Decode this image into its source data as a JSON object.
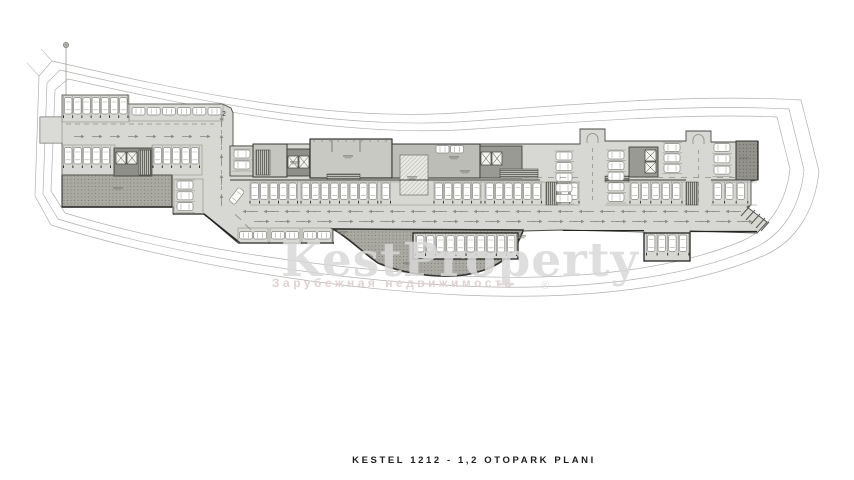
{
  "title": "KESTEL 1212 - 1,2 OTOPARK  PLANI",
  "watermark": {
    "brand": "KestProperty",
    "subtitle": "Зарубежная недвижимость",
    "registered": "®"
  },
  "plan": {
    "level_label": "2",
    "colors": {
      "structure_fill": "#d7d7d3",
      "building_fill": "#c6c6c0",
      "core_fill": "#8f8f89",
      "stipple_fill": "#a9a9a1",
      "outline": "#3a3a38",
      "boundary_line": "#b0b0ac",
      "road_mark": "#8a8a84",
      "car_fill": "#ffffff",
      "watermark_gray": "#d9d9d9",
      "watermark_rose": "#e0d2d2",
      "title_color": "#1c1c1c"
    },
    "rows_vertical_cars": [
      {
        "x": 64.5,
        "y": 97.5,
        "n": 7,
        "p": 9.2
      },
      {
        "x": 64.5,
        "y": 147.5,
        "n": 5,
        "p": 9.4
      },
      {
        "x": 154,
        "y": 147.5,
        "n": 5,
        "p": 9.3
      },
      {
        "x": 251,
        "y": 183,
        "n": 5,
        "p": 9.5
      },
      {
        "x": 302,
        "y": 183,
        "n": 8,
        "p": 9.6
      },
      {
        "x": 382,
        "y": 183,
        "n": 1,
        "p": 9.5
      },
      {
        "x": 435,
        "y": 183,
        "n": 5,
        "p": 9.4
      },
      {
        "x": 486,
        "y": 183,
        "n": 6,
        "p": 9.4
      },
      {
        "x": 561,
        "y": 183,
        "n": 2,
        "p": 9.5
      },
      {
        "x": 631,
        "y": 183,
        "n": 5,
        "p": 10.4
      },
      {
        "x": 714,
        "y": 183,
        "n": 3,
        "p": 11.6
      },
      {
        "x": 416.5,
        "y": 235.5,
        "n": 10,
        "p": 10.1
      },
      {
        "x": 647.5,
        "y": 235,
        "n": 4,
        "p": 10.6
      }
    ],
    "rows_horizontal_cars": [
      {
        "x": 132,
        "y": 107.5,
        "n": 6,
        "p": 15.2
      },
      {
        "x": 239.5,
        "y": 231.5,
        "n": 2,
        "p": 14
      },
      {
        "x": 271.5,
        "y": 231.5,
        "n": 2,
        "p": 14
      },
      {
        "x": 303.5,
        "y": 231.5,
        "n": 2,
        "p": 14
      },
      {
        "x": 436,
        "y": 145.5,
        "n": 2,
        "p": 14.5
      }
    ],
    "cols_horizontal_cars": [
      {
        "x": 177,
        "y": 181,
        "n": 3,
        "p": 10.8
      },
      {
        "x": 234,
        "y": 150,
        "n": 2,
        "p": 11
      },
      {
        "x": 556,
        "y": 152,
        "n": 5,
        "p": 10.6
      },
      {
        "x": 608,
        "y": 151,
        "n": 5,
        "p": 10.6
      },
      {
        "x": 664,
        "y": 143.5,
        "n": 3,
        "p": 10.4
      },
      {
        "x": 714,
        "y": 143.5,
        "n": 3,
        "p": 11.3
      }
    ],
    "angled_car": {
      "x": 233,
      "y": 188,
      "deg": 38
    },
    "aisle_dash": {
      "x1": 66,
      "x2": 214,
      "y": 124
    },
    "aisle_arrows": {
      "y": 136.5,
      "x1": 76,
      "step": 18,
      "n": 8
    },
    "vroad": {
      "x": 221.5,
      "y1": 114,
      "y2": 203,
      "arrows": [
        198,
        178,
        158,
        138,
        120
      ]
    },
    "road_lines": [
      {
        "y": 211.5,
        "x1": 250,
        "x2": 738,
        "step": 21,
        "dir": "left"
      },
      {
        "y": 221.5,
        "x1": 254,
        "x2": 742,
        "step": 21,
        "dir": "right"
      }
    ],
    "mid_aisle_dashes": [
      {
        "y": 177.5,
        "x1": 524,
        "x2": 578,
        "step": 12
      },
      {
        "y": 177.5,
        "x1": 633,
        "x2": 757,
        "step": 12
      }
    ],
    "v_aisles": [
      {
        "x": 592.5,
        "y1": 148,
        "y2": 204
      },
      {
        "x": 698.5,
        "y1": 150,
        "y2": 204
      }
    ],
    "u_turns": [
      {
        "cx": 592.5,
        "y": 143
      },
      {
        "cx": 698.5,
        "y": 144
      }
    ],
    "bend_dashes": [
      [
        238,
        217
      ],
      [
        248,
        227
      ]
    ],
    "micro_labels": [
      [
        118,
        189
      ],
      [
        348,
        157
      ],
      [
        412,
        178
      ],
      [
        454,
        158
      ],
      [
        744,
        159
      ],
      [
        521,
        237
      ],
      [
        408,
        264
      ],
      [
        342,
        233
      ],
      [
        295,
        163
      ],
      [
        465,
        172
      ]
    ]
  }
}
